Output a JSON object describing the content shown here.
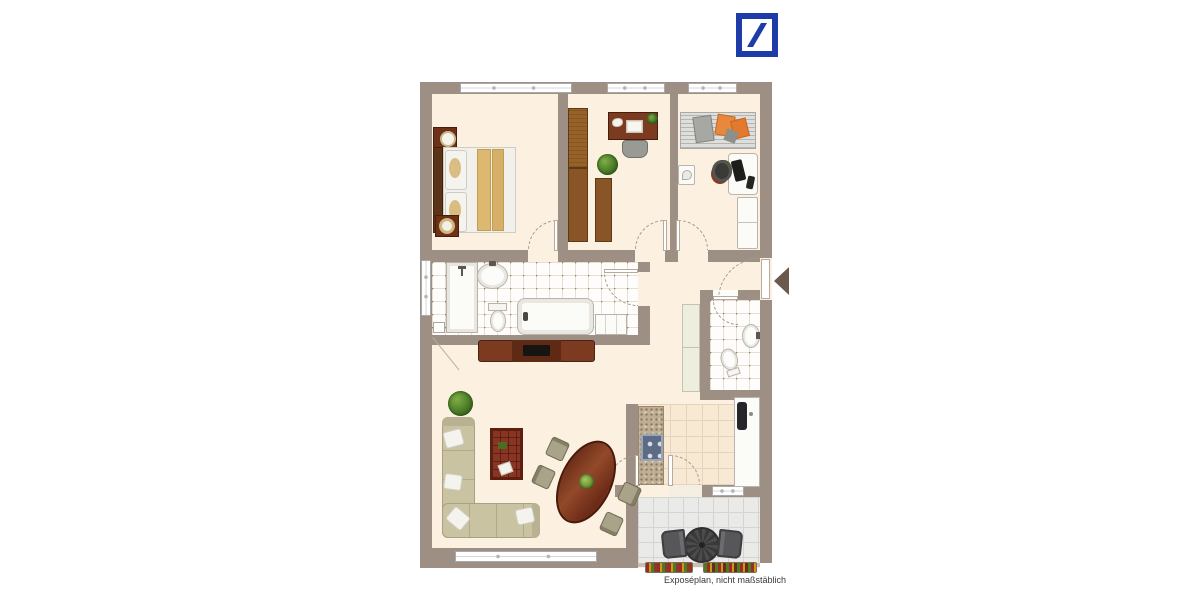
{
  "page": {
    "width": 1200,
    "height": 600,
    "background": "#ffffff"
  },
  "branding": {
    "logo": "deutsche-bank-logo",
    "logo_color": "#1E3CA8",
    "logo_shape": "blue square frame with diagonal slash"
  },
  "caption": {
    "text": "Exposéplan, nicht maßstäblich"
  },
  "palette": {
    "wall": "#9D8F83",
    "floor_cream": "#FCF1E0",
    "tile_bathroom": "#FEFDFB",
    "tile_kitchen": "#F7E9D4",
    "tile_balcony": "#EAEAE8",
    "wood_light": "#96622A",
    "wood_dark": "#6F3018",
    "sofa": "#C9C3A1",
    "blanket_tan": "#DCB871",
    "accent_orange": "#E8883C",
    "entry_arrow": "#6B5A4C"
  },
  "plan": {
    "type": "apartment-floor-plan",
    "rooms": [
      {
        "name": "bedroom",
        "furniture": [
          "double-bed",
          "nightstand-with-lamp",
          "round-stool",
          "window"
        ]
      },
      {
        "name": "study",
        "furniture": [
          "tall-wardrobe",
          "desk-with-phone-and-book",
          "office-chair",
          "potted-plant",
          "low-cabinet"
        ]
      },
      {
        "name": "utility-room",
        "furniture": [
          "drying-rack-with-laundry",
          "small-shelf",
          "white-desk-with-laptop",
          "office-chair",
          "white-wardrobe"
        ]
      },
      {
        "name": "bathroom",
        "furniture": [
          "shower",
          "washbasin",
          "toilet",
          "bathtub",
          "bath-shelf",
          "window"
        ]
      },
      {
        "name": "hallway",
        "furniture": [
          "tall-cabinet",
          "entrance-door"
        ]
      },
      {
        "name": "guest-wc",
        "furniture": [
          "washbasin",
          "toilet"
        ]
      },
      {
        "name": "kitchen",
        "furniture": [
          "counter-granite",
          "cooktop",
          "counter-white",
          "sink"
        ]
      },
      {
        "name": "living-room",
        "furniture": [
          "corner-sofa",
          "patterned-rug",
          "sideboard-tv",
          "oval-dining-table",
          "four-chairs",
          "potted-plant",
          "window"
        ]
      },
      {
        "name": "balcony",
        "furniture": [
          "round-table",
          "two-chairs",
          "flower-boxes"
        ]
      }
    ]
  }
}
